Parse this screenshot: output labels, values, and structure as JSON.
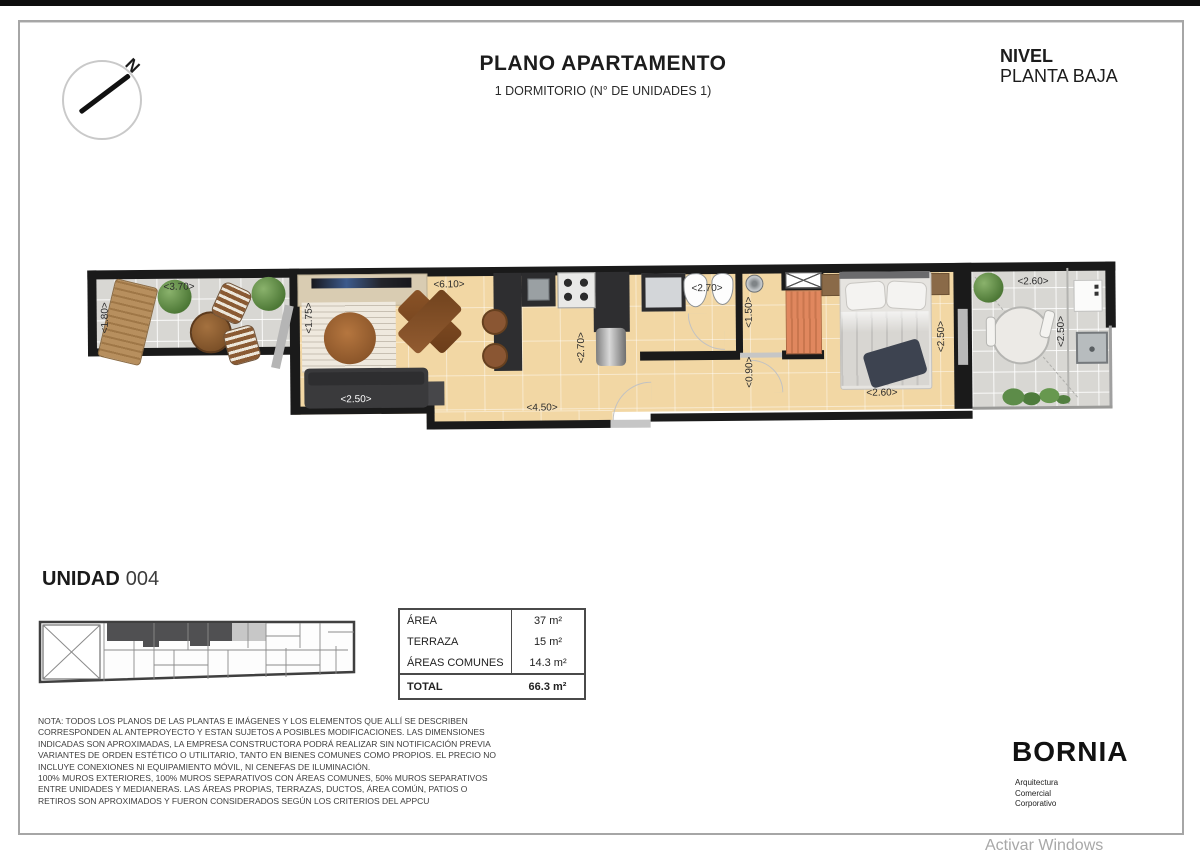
{
  "page": {
    "title": "PLANO APARTAMENTO",
    "subtitle": "1 DORMITORIO (N° DE UNIDADES 1)"
  },
  "level": {
    "label": "NIVEL",
    "value": "PLANTA BAJA"
  },
  "compass": {
    "letter": "N"
  },
  "dims": {
    "terrace_width": "<3.70>",
    "terrace_depth": "<1.80>",
    "living_left": "<1.75>",
    "living_width": "<6.10>",
    "kitchen_depth": "<2.70>",
    "sofa_width": "<2.50>",
    "entry_width": "<4.50>",
    "bath_width": "<2.70>",
    "shower_depth": "<1.50>",
    "hall_width": "<0.90>",
    "bedroom_width": "<2.60>",
    "bedroom_depth": "<2.50>",
    "terrace2_width": "<2.60>",
    "terrace2_depth": "<2.50>"
  },
  "unit": {
    "label": "UNIDAD",
    "number": "004"
  },
  "area_table": {
    "rows": [
      {
        "label": "ÁREA",
        "value": "37 m²"
      },
      {
        "label": "TERRAZA",
        "value": "15 m²"
      },
      {
        "label": "ÁREAS COMUNES",
        "value": "14.3 m²"
      }
    ],
    "total_label": "TOTAL",
    "total_value": "66.3 m²"
  },
  "note": {
    "para1": "NOTA: TODOS LOS PLANOS DE LAS PLANTAS E IMÁGENES Y LOS ELEMENTOS QUE ALLÍ SE DESCRIBEN CORRESPONDEN AL ANTEPROYECTO Y ESTAN SUJETOS A POSIBLES MODIFICACIONES. LAS DIMENSIONES INDICADAS SON APROXIMADAS, LA EMPRESA CONSTRUCTORA PODRÁ REALIZAR SIN NOTIFICACIÓN PREVIA VARIANTES DE ORDEN ESTÉTICO O UTILITARIO, TANTO EN BIENES COMUNES COMO PROPIOS. EL PRECIO NO INCLUYE CONEXIONES NI EQUIPAMIENTO MÓVIL, NI CENEFAS DE ILUMINACIÓN.",
    "para2": "100% MUROS EXTERIORES, 100% MUROS SEPARATIVOS CON ÁREAS COMUNES, 50% MUROS SEPARATIVOS ENTRE UNIDADES Y MEDIANERAS. LAS ÁREAS PROPIAS, TERRAZAS, DUCTOS, ÁREA COMÚN, PATIOS O RETIROS SON APROXIMADOS Y FUERON CONSIDERADOS SEGÚN LOS CRITERIOS DEL APPCU"
  },
  "brand": {
    "name": "BORNIA",
    "tagline1": "Arquitectura",
    "tagline2": "Comercial",
    "tagline3": "Corporativo"
  },
  "watermark": "Activar Windows",
  "colors": {
    "wall": "#1a1a1a",
    "floor_wood": "#f2d7a4",
    "floor_tile": "#d8d7d3",
    "closet_orange": "#e0875e",
    "plant_green": "#5d8c49",
    "furniture_dark": "#3a3a3c",
    "wood_brown": "#8a5a33"
  }
}
